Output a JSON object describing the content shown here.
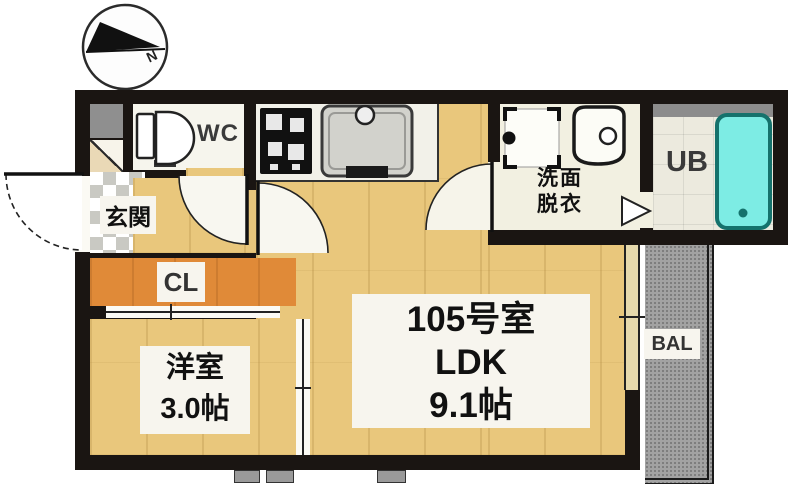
{
  "compass": {
    "north_label": "N"
  },
  "rooms": {
    "entrance": {
      "label": "玄関"
    },
    "toilet": {
      "label": "WC"
    },
    "closet": {
      "label": "CL"
    },
    "washroom": {
      "label_line1": "洗面",
      "label_line2": "脱衣"
    },
    "unit_bath": {
      "label": "UB"
    },
    "western_room": {
      "name": "洋室",
      "size": "3.0帖"
    },
    "ldk": {
      "room_number": "105号室",
      "layout": "LDK",
      "size": "9.1帖"
    },
    "balcony": {
      "label": "BAL"
    }
  },
  "colors": {
    "wall": "#1a1512",
    "wood_floor": "#e9c77c",
    "closet_floor": "#e08a38",
    "entrance_tile": "#c9c9c3",
    "washroom_floor": "#f2f0e1",
    "bathtub": "#7dece4",
    "balcony": "#a2a2a2"
  }
}
